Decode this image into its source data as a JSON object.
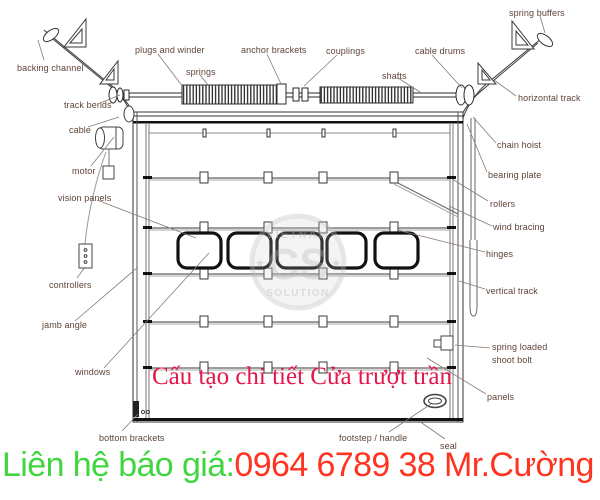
{
  "title": {
    "text": "Cấu tạo chi tiết Cửa trượt trần"
  },
  "contact": {
    "prefix": "Liên hệ báo giá:",
    "phone": "0964 6789 38 Mr.Cường"
  },
  "watermark": {
    "top": "VIETNAM",
    "monogram": "CS",
    "bottom": "SOLUTION",
    "star_left": "★",
    "star_right": "★"
  },
  "colors": {
    "c-title": "#e3174b",
    "c-green": "#41d641",
    "c-red": "#ff3420",
    "c-label": "#5d4437",
    "c-leader": "#8a7a6e"
  },
  "diagram": {
    "labels": [
      {
        "id": "backing-channel",
        "text": "backing channel",
        "x": 17,
        "y": 62
      },
      {
        "id": "plugs-and-winder",
        "text": "plugs and winder",
        "x": 135,
        "y": 44
      },
      {
        "id": "springs",
        "text": "springs",
        "x": 186,
        "y": 66
      },
      {
        "id": "anchor-brackets",
        "text": "anchor brackets",
        "x": 241,
        "y": 44
      },
      {
        "id": "couplings",
        "text": "couplings",
        "x": 326,
        "y": 45
      },
      {
        "id": "cable-drums",
        "text": "cable drums",
        "x": 415,
        "y": 45
      },
      {
        "id": "shafts",
        "text": "shafts",
        "x": 382,
        "y": 70
      },
      {
        "id": "spring-buffers",
        "text": "spring buffers",
        "x": 509,
        "y": 7
      },
      {
        "id": "horizontal-track",
        "text": "horizontal track",
        "x": 518,
        "y": 92
      },
      {
        "id": "track-bends",
        "text": "track bends",
        "x": 64,
        "y": 99
      },
      {
        "id": "cable",
        "text": "cable",
        "x": 69,
        "y": 124
      },
      {
        "id": "motor",
        "text": "motor",
        "x": 72,
        "y": 165
      },
      {
        "id": "vision-panels",
        "text": "vision panels",
        "x": 58,
        "y": 192
      },
      {
        "id": "controllers",
        "text": "controllers",
        "x": 49,
        "y": 279
      },
      {
        "id": "jamb-angle",
        "text": "jamb angle",
        "x": 42,
        "y": 319
      },
      {
        "id": "windows",
        "text": "windows",
        "x": 75,
        "y": 366
      },
      {
        "id": "bottom-brackets",
        "text": "bottom brackets",
        "x": 99,
        "y": 432
      },
      {
        "id": "chain-hoist",
        "text": "chain hoist",
        "x": 497,
        "y": 139
      },
      {
        "id": "bearing-plate",
        "text": "bearing plate",
        "x": 488,
        "y": 169
      },
      {
        "id": "rollers",
        "text": "rollers",
        "x": 490,
        "y": 198
      },
      {
        "id": "wind-bracing",
        "text": "wind bracing",
        "x": 493,
        "y": 221
      },
      {
        "id": "hinges",
        "text": "hinges",
        "x": 486,
        "y": 248
      },
      {
        "id": "vertical-track",
        "text": "vertical track",
        "x": 486,
        "y": 285
      },
      {
        "id": "spring-loaded-shoot-bolt",
        "text": "spring loaded shoot bolt",
        "x": 492,
        "y": 341,
        "w": 62
      },
      {
        "id": "panels",
        "text": "panels",
        "x": 487,
        "y": 391
      },
      {
        "id": "footstep-handle",
        "text": "footstep / handle",
        "x": 339,
        "y": 432
      },
      {
        "id": "seal",
        "text": "seal",
        "x": 440,
        "y": 440
      }
    ],
    "leaders": [
      [
        44,
        60,
        38,
        40
      ],
      [
        158,
        54,
        183,
        87
      ],
      [
        200,
        75,
        208,
        85
      ],
      [
        267,
        54,
        281,
        84
      ],
      [
        337,
        55,
        304,
        86
      ],
      [
        432,
        55,
        462,
        88
      ],
      [
        398,
        78,
        420,
        92
      ],
      [
        540,
        16,
        545,
        33
      ],
      [
        516,
        96,
        494,
        80
      ],
      [
        100,
        103,
        120,
        95
      ],
      [
        88,
        127,
        119,
        117
      ],
      [
        91,
        166,
        114,
        137
      ],
      [
        97,
        200,
        196,
        238
      ],
      [
        77,
        278,
        85,
        267
      ],
      [
        75,
        321,
        138,
        267
      ],
      [
        104,
        368,
        209,
        253
      ],
      [
        122,
        431,
        138,
        414
      ],
      [
        496,
        143,
        473,
        117
      ],
      [
        487,
        172,
        467,
        124
      ],
      [
        488,
        201,
        452,
        179
      ],
      [
        492,
        226,
        449,
        206
      ],
      [
        485,
        252,
        397,
        230
      ],
      [
        485,
        289,
        459,
        281
      ],
      [
        490,
        348,
        455,
        345
      ],
      [
        486,
        394,
        427,
        358
      ],
      [
        389,
        432,
        431,
        404
      ],
      [
        445,
        439,
        419,
        421
      ]
    ]
  }
}
